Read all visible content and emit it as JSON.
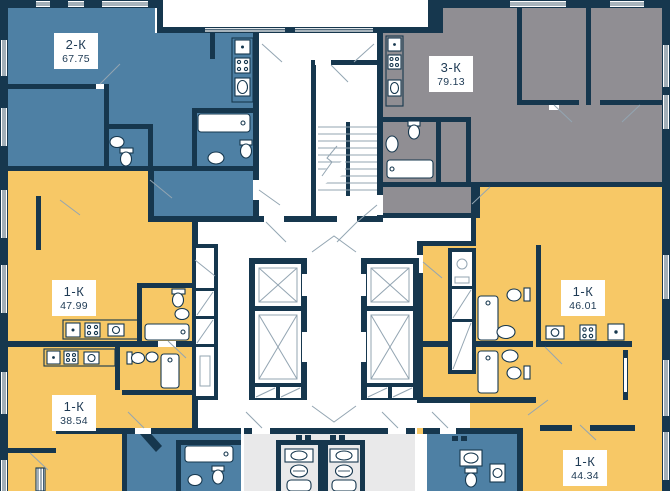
{
  "palette": {
    "wall": "#16374E",
    "blue": "#4E80A4",
    "yellow": "#F7C866",
    "gray": "#908E93",
    "light": "#E9E9EA",
    "white": "#FFFFFF",
    "line": "#93A5B2",
    "label-bg": "#FFFFFF",
    "label-text": "#1E3A54"
  },
  "apartments": [
    {
      "type": "2-К",
      "area": "67.75",
      "color": "blue"
    },
    {
      "type": "3-К",
      "area": "79.13",
      "color": "gray"
    },
    {
      "type": "1-К",
      "area": "47.99",
      "color": "yellow"
    },
    {
      "type": "1-К",
      "area": "38.54",
      "color": "yellow"
    },
    {
      "type": "1-К",
      "area": "46.01",
      "color": "yellow"
    },
    {
      "type": "1-К",
      "area": "44.34",
      "color": "yellow"
    }
  ],
  "icons": {
    "elevator-shaft-icon": "crossed-box",
    "vent-shaft-icon": "diagonal-box",
    "stairs-icon": "tread-lines",
    "toilet-icon": "ellipse-with-tank",
    "sink-icon": "oval-basin",
    "bathtub-icon": "rounded-rect",
    "shower-tray-icon": "rounded-square",
    "stove-icon": "four-burners",
    "fridge-icon": "square-with-dot",
    "washing-machine-icon": "square-with-circle",
    "radiator-icon": "striped-bar",
    "door-swing-icon": "diagonal-line",
    "window-icon": "striped-wall-gap"
  }
}
